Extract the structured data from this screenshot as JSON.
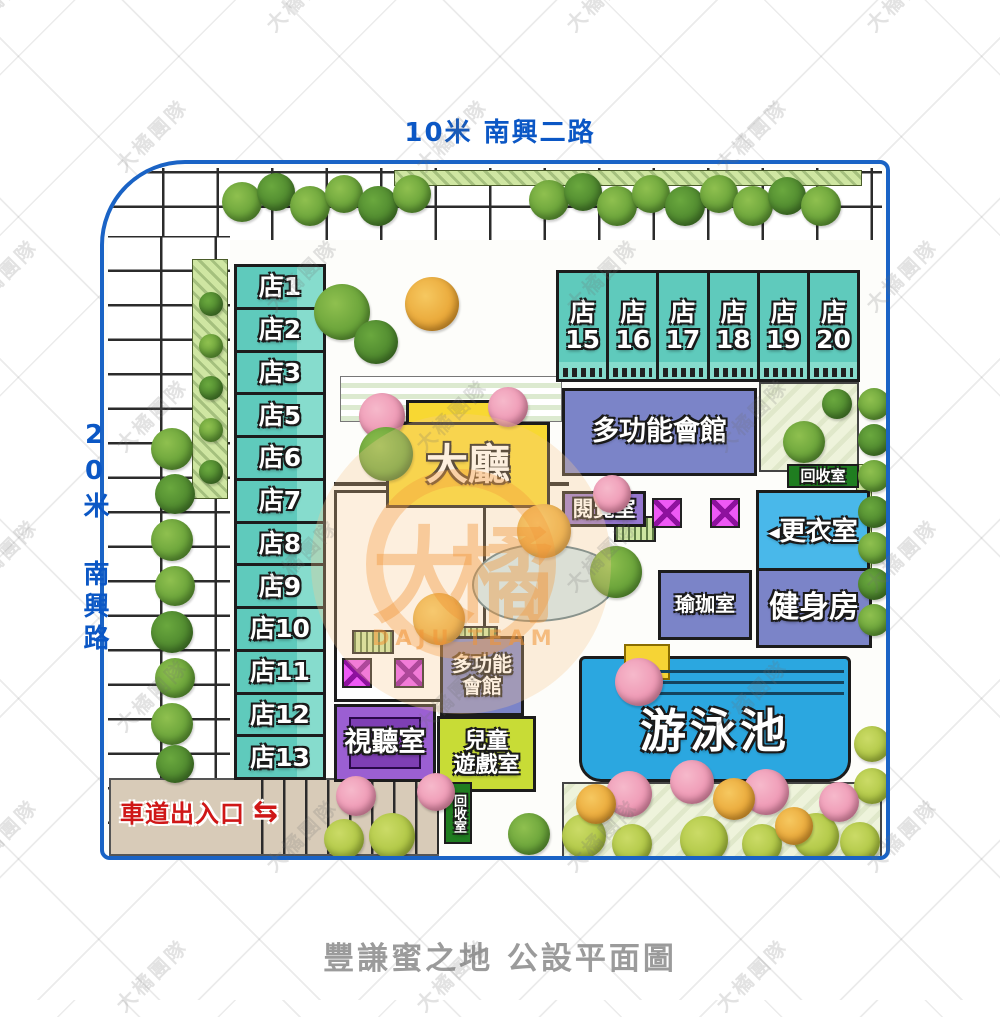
{
  "page": {
    "title_bottom": "豐謙蜜之地 公設平面圖"
  },
  "roads": {
    "top_label": "10米 南興二路",
    "left_label": "20米 南興路"
  },
  "watermark": {
    "tile_text": "大橘團隊",
    "logo_text": "大橘",
    "logo_subtext": "DAJU TEAM"
  },
  "shops": {
    "left_column": [
      "店1",
      "店2",
      "店3",
      "店5",
      "店6",
      "店7",
      "店8",
      "店9",
      "店10",
      "店11",
      "店12",
      "店13"
    ],
    "top_row_prefix": "店",
    "top_row_numbers": [
      "15",
      "16",
      "17",
      "18",
      "19",
      "20"
    ]
  },
  "facilities": {
    "multi_hall_top": "多功能會館",
    "lobby": "大廳",
    "reading_room": "閱覽室",
    "recycle_room": "回收室",
    "changing_room": "更衣室",
    "changing_arrow": "◀",
    "yoga_room": "瑜珈室",
    "gym": "健身房",
    "pool": "游泳池",
    "av_room": "視聽室",
    "multi_hall_center": [
      "多功能",
      "會館"
    ],
    "kids_room": [
      "兒童",
      "遊戲室"
    ],
    "recycle_room_bottom": "回收室",
    "driveway_label": "車道出入口",
    "driveway_arrows": "⇆"
  },
  "colors": {
    "shop_teal": "#5fcabc",
    "hall_purple": "#7b84c8",
    "lobby_yellow": "#f8d832",
    "reading_purple": "#9577cf",
    "av_purple": "#9b5fd2",
    "av_purple_dark": "#7e3fb4",
    "kids_green": "#c8dc36",
    "pool_blue": "#2ba7e0",
    "changing_blue": "#49b8ea",
    "recycle_green": "#1f7d20",
    "driveway_red": "#cf1717",
    "border_blue": "#1a63c5",
    "road_text_blue": "#0b57c5",
    "title_gray": "#9b9b9b",
    "elevator_magenta": "#ee59f5"
  }
}
